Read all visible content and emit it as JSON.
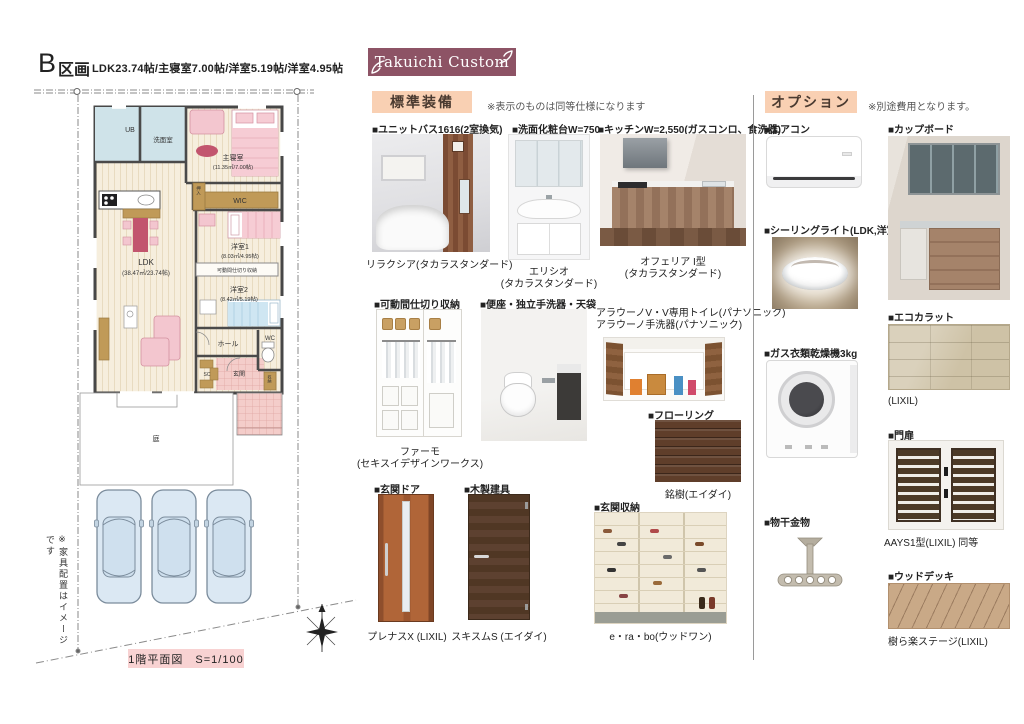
{
  "header": {
    "plot_letter": "B",
    "plot_word": "区画",
    "specs": "LDK23.74帖/主寝室7.00帖/洋室5.19帖/洋室4.95帖",
    "brand": "Takuichi Custom"
  },
  "standard": {
    "title": "標準装備",
    "note": "※表示のものは同等仕様になります",
    "unit_bath": {
      "title": "■ユニットバス1616(2室換気)",
      "caption": "リラクシア(タカラスタンダード)"
    },
    "vanity": {
      "title": "■洗面化粧台W=750",
      "caption1": "エリシオ",
      "caption2": "(タカラスタンダード)"
    },
    "kitchen": {
      "title": "■キッチンW=2,550(ガスコンロ、食洗器)",
      "caption1": "オフェリア I型",
      "caption2": "(タカラスタンダード)"
    },
    "partition": {
      "title": "■可動間仕切り収納",
      "caption1": "ファーモ",
      "caption2": "(セキスイデザインワークス)"
    },
    "toilet": {
      "title": "■便座・独立手洗器・天袋",
      "note1": "アラウーノV・V専用トイレ(パナソニック)",
      "note2": "アラウーノ手洗器(パナソニック)"
    },
    "flooring": {
      "title": "■フローリング",
      "caption": "銘樹(エイダイ)"
    },
    "entrance_door": {
      "title": "■玄関ドア",
      "caption": "プレナスX (LIXIL)"
    },
    "wood_door": {
      "title": "■木製建具",
      "caption": "スキスムS (エイダイ)"
    },
    "shoe_storage": {
      "title": "■玄関収納",
      "caption": "e・ra・bo(ウッドワン)"
    }
  },
  "options": {
    "title": "オプション",
    "note": "※別途費用となります。",
    "aircon": {
      "title": "■エアコン"
    },
    "ceiling_light": {
      "title": "■シーリングライト(LDK,洋室)"
    },
    "gas_dryer": {
      "title": "■ガス衣類乾燥機3kg"
    },
    "laundry_hanger": {
      "title": "■物干金物"
    },
    "cupboard": {
      "title": "■カップボード"
    },
    "ecocarat": {
      "title": "■エコカラット",
      "caption": "(LIXIL)"
    },
    "gate": {
      "title": "■門扉",
      "caption": "AAYS1型(LIXIL) 同等"
    },
    "wood_deck": {
      "title": "■ウッドデッキ",
      "caption": "樹ら楽ステージ(LIXIL)"
    }
  },
  "plan": {
    "footer": "1階平面図　S=1/100",
    "furniture_note": "※家具配置はイメージです",
    "rooms": {
      "ub": "UB",
      "senmen": "洗面室",
      "master": "主寝室",
      "master_size": "(11.35㎡/7.00帖)",
      "wic": "WIC",
      "oshiire": "押入",
      "ldk": "LDK",
      "ldk_size": "(38.47㎡/23.74帖)",
      "yoshitsu1": "洋室1",
      "yoshitsu1_size": "(8.03㎡/4.95帖)",
      "partition": "可動間仕切り収納",
      "yoshitsu2": "洋室2",
      "yoshitsu2_size": "(8.42㎡/5.19帖)",
      "hall": "ホール",
      "wc": "WC",
      "sc": "SC",
      "genkan": "玄関",
      "shuno": "収納",
      "garden": "庭"
    }
  },
  "colors": {
    "banner": "#8d5365",
    "section_header_bg": "#f9d0b3",
    "plan_footer_bg": "#f8d2d2"
  }
}
